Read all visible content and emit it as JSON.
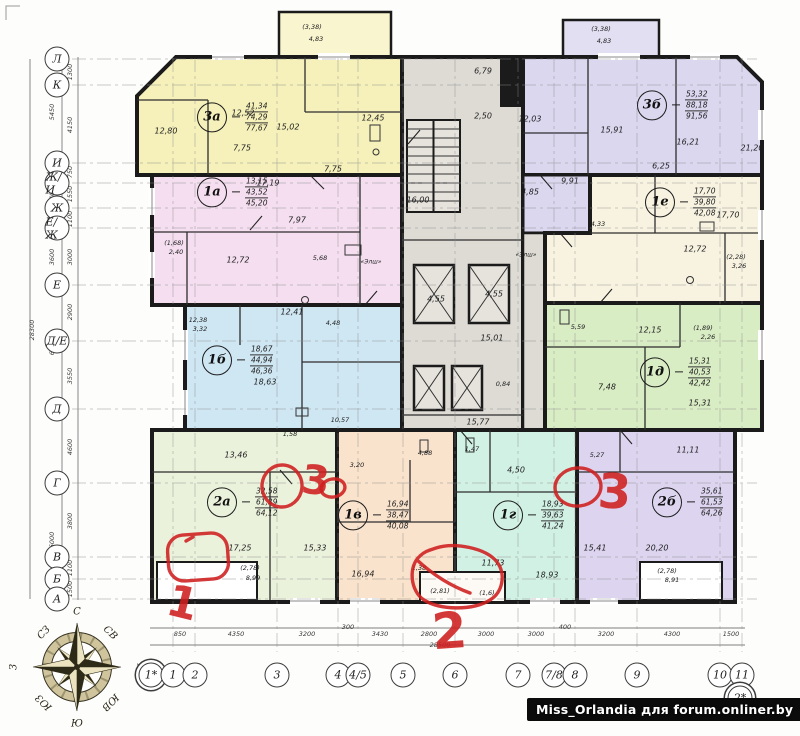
{
  "watermark": "Miss_Orlandia для forum.onliner.by",
  "palette": {
    "walls": "#1b1b1b",
    "core": "#dedbd4",
    "apt_3a": "#f6f1ba",
    "apt_3b": "#dad7ef",
    "apt_1a": "#f4def0",
    "apt_1e": "#f8f3e1",
    "apt_1b": "#cfe7f3",
    "apt_1d": "#d9edc5",
    "apt_2a": "#ebf2dc",
    "apt_1v": "#fae3cd",
    "apt_1g": "#d2f1e5",
    "apt_2b": "#ddd5f0",
    "annotation_red": "#cf1f1f",
    "compass_dark": "#2e2a18",
    "compass_light": "#ece4c0"
  },
  "apartments": [
    {
      "code": "3а",
      "areas": [
        "41,34",
        "74,29",
        "77,67"
      ],
      "cx": 212,
      "cy": 117
    },
    {
      "code": "3б",
      "areas": [
        "53,32",
        "88,18",
        "91,56"
      ],
      "cx": 652,
      "cy": 105
    },
    {
      "code": "1а",
      "areas": [
        "13,15",
        "43,52",
        "45,20"
      ],
      "cx": 212,
      "cy": 192
    },
    {
      "code": "1е",
      "areas": [
        "17,70",
        "39,80",
        "42,08"
      ],
      "cx": 660,
      "cy": 202
    },
    {
      "code": "1б",
      "areas": [
        "18,67",
        "44,94",
        "46,36"
      ],
      "cx": 217,
      "cy": 360
    },
    {
      "code": "1д",
      "areas": [
        "15,31",
        "40,53",
        "42,42"
      ],
      "cx": 655,
      "cy": 372
    },
    {
      "code": "2а",
      "areas": [
        "32,58",
        "61,39",
        "64,12"
      ],
      "cx": 222,
      "cy": 502
    },
    {
      "code": "1в",
      "areas": [
        "16,94",
        "38,47",
        "40,08"
      ],
      "cx": 353,
      "cy": 515
    },
    {
      "code": "1г",
      "areas": [
        "18,93",
        "39,63",
        "41,24"
      ],
      "cx": 508,
      "cy": 515
    },
    {
      "code": "2б",
      "areas": [
        "35,61",
        "61,53",
        "64,26"
      ],
      "cx": 667,
      "cy": 502
    }
  ],
  "room_labels": [
    {
      "t": "(3,38)",
      "x": 312,
      "y": 27,
      "s": 6.5
    },
    {
      "t": "4,83",
      "x": 316,
      "y": 39,
      "s": 6.5
    },
    {
      "t": "(3,38)",
      "x": 601,
      "y": 29,
      "s": 6.5
    },
    {
      "t": "4,83",
      "x": 604,
      "y": 41,
      "s": 6.5
    },
    {
      "t": "12,80",
      "x": 166,
      "y": 131
    },
    {
      "t": "12,52",
      "x": 243,
      "y": 113
    },
    {
      "t": "15,02",
      "x": 288,
      "y": 127
    },
    {
      "t": "7,75",
      "x": 242,
      "y": 148
    },
    {
      "t": "7,75",
      "x": 333,
      "y": 169
    },
    {
      "t": "12,45",
      "x": 373,
      "y": 118
    },
    {
      "t": "12,03",
      "x": 530,
      "y": 119
    },
    {
      "t": "15,91",
      "x": 612,
      "y": 130
    },
    {
      "t": "16,21",
      "x": 688,
      "y": 142
    },
    {
      "t": "21,20",
      "x": 752,
      "y": 148
    },
    {
      "t": "6,25",
      "x": 661,
      "y": 166
    },
    {
      "t": "9,91",
      "x": 570,
      "y": 181
    },
    {
      "t": "4,85",
      "x": 530,
      "y": 192
    },
    {
      "t": "6,79",
      "x": 483,
      "y": 71
    },
    {
      "t": "2,50",
      "x": 483,
      "y": 116
    },
    {
      "t": "16,00",
      "x": 418,
      "y": 200
    },
    {
      "t": "«Элш»",
      "x": 371,
      "y": 262,
      "s": 6
    },
    {
      "t": "«Элш»",
      "x": 526,
      "y": 255,
      "s": 6
    },
    {
      "t": "4,55",
      "x": 436,
      "y": 299
    },
    {
      "t": "4,55",
      "x": 494,
      "y": 294
    },
    {
      "t": "15,01",
      "x": 492,
      "y": 338
    },
    {
      "t": "0,84",
      "x": 503,
      "y": 384,
      "s": 6.5
    },
    {
      "t": "15,77",
      "x": 478,
      "y": 422
    },
    {
      "t": "10,57",
      "x": 340,
      "y": 420,
      "s": 6.5
    },
    {
      "t": "17,19",
      "x": 268,
      "y": 183
    },
    {
      "t": "7,97",
      "x": 297,
      "y": 220
    },
    {
      "t": "12,72",
      "x": 238,
      "y": 260
    },
    {
      "t": "5,68",
      "x": 320,
      "y": 258,
      "s": 6.5
    },
    {
      "t": "(1,68)",
      "x": 174,
      "y": 243,
      "s": 6.5
    },
    {
      "t": "2,40",
      "x": 176,
      "y": 252,
      "s": 6.5
    },
    {
      "t": "17,70",
      "x": 728,
      "y": 215
    },
    {
      "t": "12,72",
      "x": 695,
      "y": 249
    },
    {
      "t": "(2,28)",
      "x": 736,
      "y": 257,
      "s": 6.5
    },
    {
      "t": "3,26",
      "x": 739,
      "y": 266,
      "s": 6.5
    },
    {
      "t": "4,33",
      "x": 598,
      "y": 224,
      "s": 6.5
    },
    {
      "t": "12,38",
      "x": 198,
      "y": 320,
      "s": 6.5
    },
    {
      "t": "3,32",
      "x": 200,
      "y": 329,
      "s": 6.5
    },
    {
      "t": "12,41",
      "x": 292,
      "y": 312
    },
    {
      "t": "4,48",
      "x": 333,
      "y": 323,
      "s": 6.5
    },
    {
      "t": "18,63",
      "x": 265,
      "y": 382
    },
    {
      "t": "1,58",
      "x": 290,
      "y": 434,
      "s": 6.5
    },
    {
      "t": "12,15",
      "x": 650,
      "y": 330
    },
    {
      "t": "7,48",
      "x": 607,
      "y": 387
    },
    {
      "t": "15,31",
      "x": 700,
      "y": 403
    },
    {
      "t": "5,59",
      "x": 578,
      "y": 327,
      "s": 6.5
    },
    {
      "t": "(1,89)",
      "x": 703,
      "y": 328,
      "s": 6.5
    },
    {
      "t": "2,26",
      "x": 708,
      "y": 337,
      "s": 6.5
    },
    {
      "t": "13,46",
      "x": 236,
      "y": 455
    },
    {
      "t": "17,25",
      "x": 240,
      "y": 548
    },
    {
      "t": "15,33",
      "x": 315,
      "y": 548
    },
    {
      "t": "3,20",
      "x": 357,
      "y": 465,
      "s": 6.5
    },
    {
      "t": "(2,78)",
      "x": 250,
      "y": 568,
      "s": 6.5
    },
    {
      "t": "8,99",
      "x": 253,
      "y": 578,
      "s": 6.5
    },
    {
      "t": "16,94",
      "x": 363,
      "y": 574
    },
    {
      "t": "1,38",
      "x": 419,
      "y": 568,
      "s": 6.5
    },
    {
      "t": "4,88",
      "x": 425,
      "y": 453,
      "s": 6.5
    },
    {
      "t": "(2,81)",
      "x": 440,
      "y": 591,
      "s": 6.5
    },
    {
      "t": "(1,6)",
      "x": 487,
      "y": 593,
      "s": 6.5
    },
    {
      "t": "1,47",
      "x": 472,
      "y": 449,
      "s": 6.5
    },
    {
      "t": "4,50",
      "x": 516,
      "y": 470
    },
    {
      "t": "11,73",
      "x": 493,
      "y": 563
    },
    {
      "t": "18,93",
      "x": 547,
      "y": 575
    },
    {
      "t": "5,27",
      "x": 597,
      "y": 455,
      "s": 6.5
    },
    {
      "t": "11,11",
      "x": 688,
      "y": 450
    },
    {
      "t": "15,41",
      "x": 595,
      "y": 548
    },
    {
      "t": "20,20",
      "x": 657,
      "y": 548
    },
    {
      "t": "(2,78)",
      "x": 667,
      "y": 571,
      "s": 6.5
    },
    {
      "t": "8,91",
      "x": 672,
      "y": 580,
      "s": 6.5
    }
  ],
  "axes": {
    "left": [
      {
        "l": "Л",
        "y": 59
      },
      {
        "l": "К",
        "y": 85
      },
      {
        "l": "И",
        "y": 163
      },
      {
        "l": "Ж/И",
        "y": 183
      },
      {
        "l": "Ж",
        "y": 208
      },
      {
        "l": "Е/Ж",
        "y": 228
      },
      {
        "l": "Е",
        "y": 285
      },
      {
        "l": "Д/Е",
        "y": 341
      },
      {
        "l": "Д",
        "y": 409
      },
      {
        "l": "Г",
        "y": 483
      },
      {
        "l": "В",
        "y": 557
      },
      {
        "l": "Б",
        "y": 579
      },
      {
        "l": "А",
        "y": 599
      }
    ],
    "bottom": [
      {
        "l": "1*",
        "x": 151,
        "d": true
      },
      {
        "l": "1",
        "x": 173
      },
      {
        "l": "2",
        "x": 195
      },
      {
        "l": "3",
        "x": 277
      },
      {
        "l": "4",
        "x": 338
      },
      {
        "l": "4/5",
        "x": 358
      },
      {
        "l": "5",
        "x": 403
      },
      {
        "l": "6",
        "x": 455
      },
      {
        "l": "7",
        "x": 518
      },
      {
        "l": "7/8",
        "x": 554
      },
      {
        "l": "8",
        "x": 575
      },
      {
        "l": "9",
        "x": 637
      },
      {
        "l": "10",
        "x": 720
      },
      {
        "l": "11",
        "x": 742
      },
      {
        "l": "2*",
        "x": 740,
        "y": 698,
        "d": true
      }
    ]
  },
  "dimensions": {
    "bottom": [
      {
        "t": "850",
        "x": 180
      },
      {
        "t": "4350",
        "x": 236
      },
      {
        "t": "3200",
        "x": 307
      },
      {
        "t": "300",
        "x": 348,
        "y": 627
      },
      {
        "t": "3430",
        "x": 380
      },
      {
        "t": "2800",
        "x": 429
      },
      {
        "t": "28500",
        "x": 440,
        "y": 645
      },
      {
        "t": "3000",
        "x": 486
      },
      {
        "t": "3000",
        "x": 536
      },
      {
        "t": "400",
        "x": 565,
        "y": 627
      },
      {
        "t": "3200",
        "x": 606
      },
      {
        "t": "4300",
        "x": 672
      },
      {
        "t": "1500",
        "x": 731
      }
    ],
    "left": [
      {
        "t": "1300",
        "x": 70,
        "y": 72
      },
      {
        "t": "4150",
        "x": 70,
        "y": 125
      },
      {
        "t": "5450",
        "x": 52,
        "y": 112
      },
      {
        "t": "750",
        "x": 70,
        "y": 172
      },
      {
        "t": "1550",
        "x": 70,
        "y": 194
      },
      {
        "t": "3400",
        "x": 52,
        "y": 196
      },
      {
        "t": "1100",
        "x": 70,
        "y": 219
      },
      {
        "t": "3000",
        "x": 70,
        "y": 257
      },
      {
        "t": "3600",
        "x": 52,
        "y": 257
      },
      {
        "t": "2900",
        "x": 70,
        "y": 312
      },
      {
        "t": "3550",
        "x": 70,
        "y": 376
      },
      {
        "t": "6450",
        "x": 52,
        "y": 347
      },
      {
        "t": "4600",
        "x": 70,
        "y": 447
      },
      {
        "t": "3800",
        "x": 70,
        "y": 521
      },
      {
        "t": "6000",
        "x": 52,
        "y": 540
      },
      {
        "t": "1100",
        "x": 70,
        "y": 568
      },
      {
        "t": "1500",
        "x": 70,
        "y": 589
      },
      {
        "t": "28300",
        "x": 32,
        "y": 330
      }
    ]
  },
  "compass": {
    "points": [
      {
        "l": "С",
        "x": 77,
        "y": 612,
        "r": 0
      },
      {
        "l": "Ю",
        "x": 77,
        "y": 724,
        "r": 0
      },
      {
        "l": "З",
        "x": 14,
        "y": 667,
        "r": -90
      },
      {
        "l": "В",
        "x": 140,
        "y": 667,
        "r": 90
      },
      {
        "l": "СЗ",
        "x": 44,
        "y": 633,
        "r": -45
      },
      {
        "l": "СВ",
        "x": 110,
        "y": 633,
        "r": 45
      },
      {
        "l": "ЮЗ",
        "x": 44,
        "y": 702,
        "r": -135
      },
      {
        "l": "ЮВ",
        "x": 110,
        "y": 702,
        "r": 135
      }
    ]
  },
  "annotations": [
    {
      "n": "1"
    },
    {
      "n": "2"
    },
    {
      "n": "3"
    },
    {
      "n": "3"
    }
  ]
}
